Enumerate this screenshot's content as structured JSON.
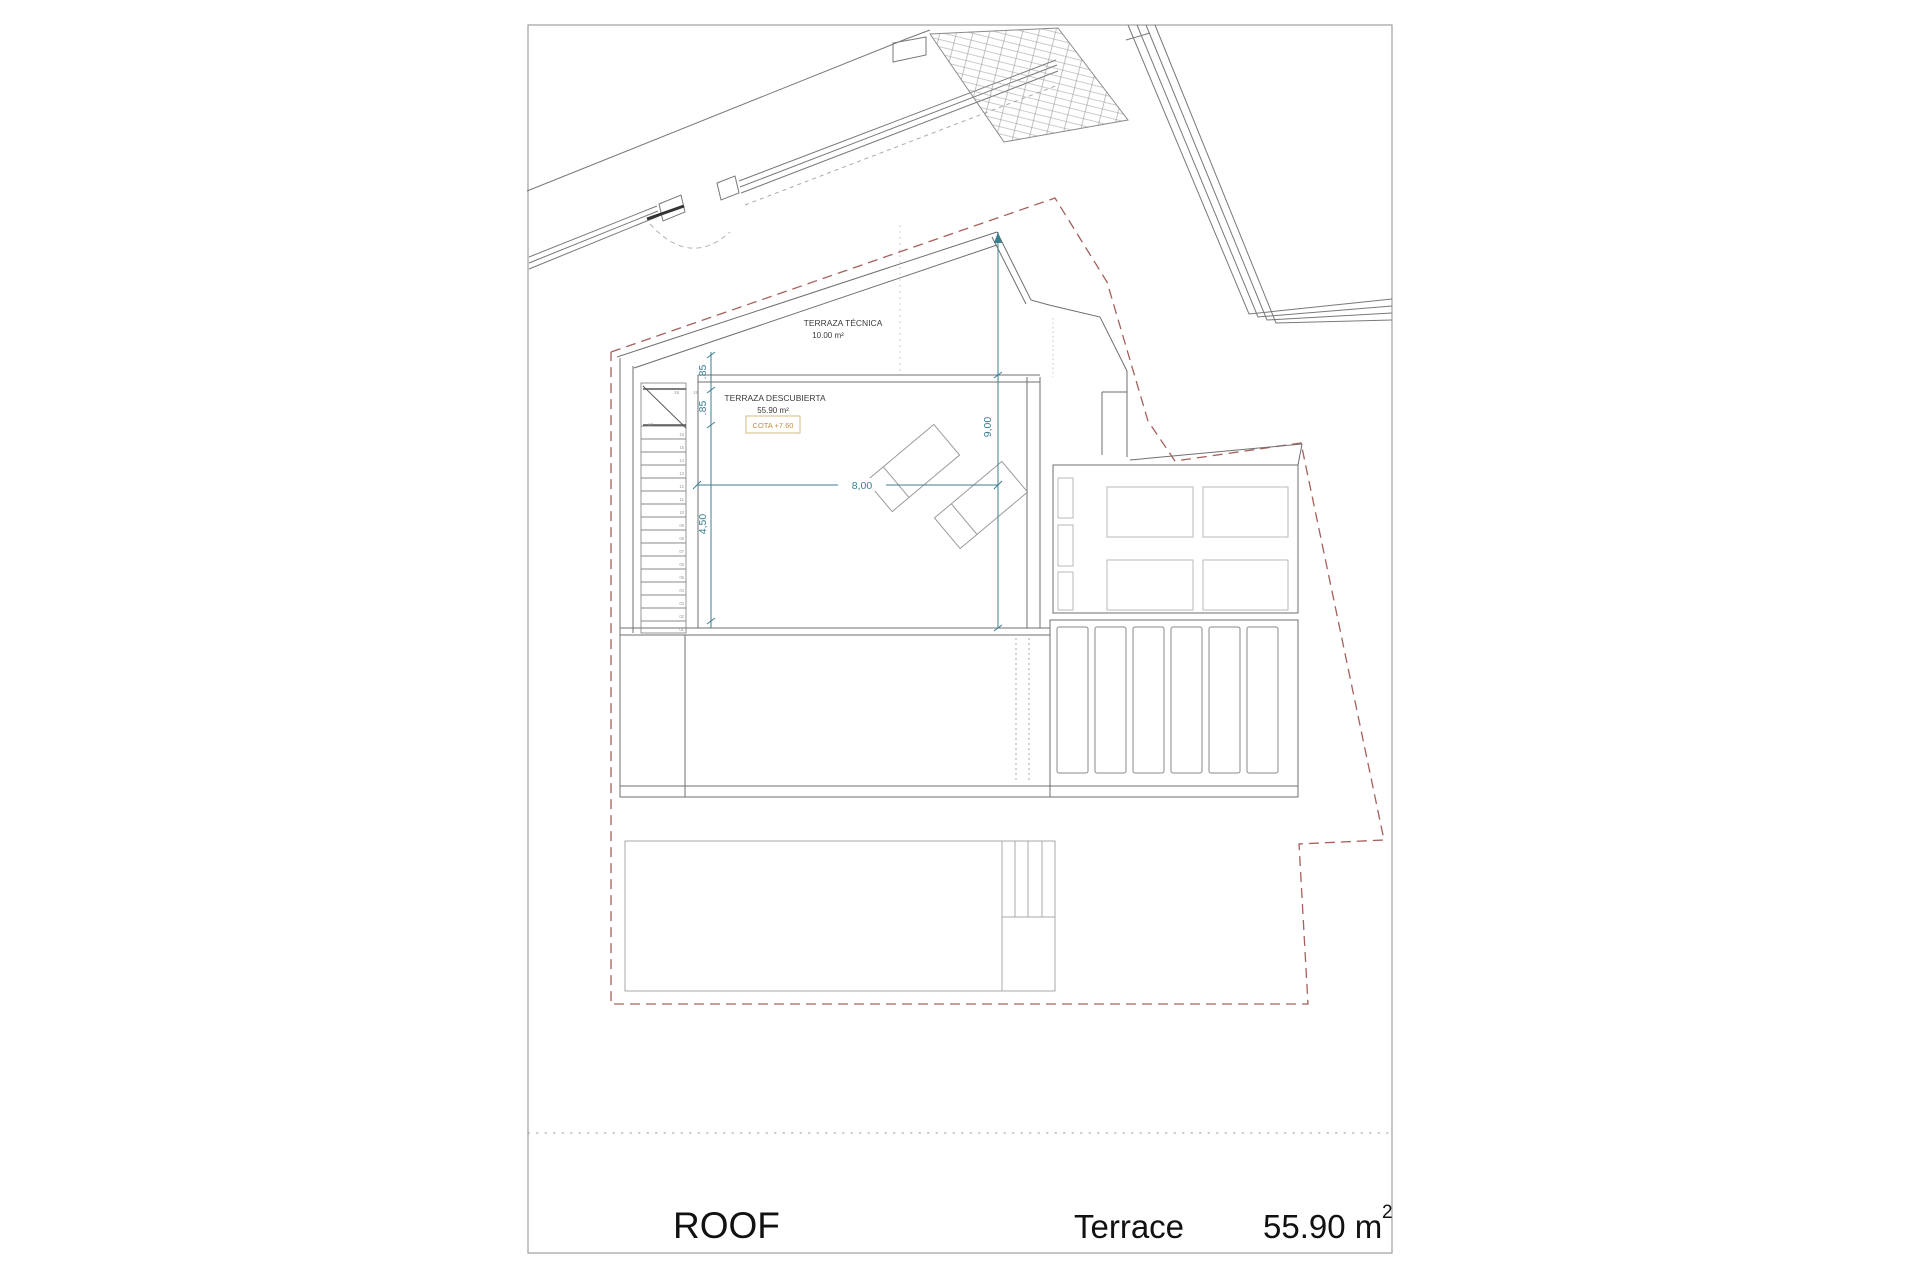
{
  "titleblock": {
    "floor": "ROOF",
    "space": "Terrace",
    "area_value": "55.90 m",
    "area_sup": "2"
  },
  "labels": {
    "tecnica_name": "TERRAZA TÉCNICA",
    "tecnica_area": "10.00 m²",
    "descubierta_name": "TERRAZA DESCUBIERTA",
    "descubierta_area": "55.90 m²",
    "cota": "COTA +7.60"
  },
  "dims": {
    "offset_top": ".85",
    "offset_mid": ".85",
    "depth": "4,50",
    "width": "8,00",
    "height": "9,00"
  },
  "stairs": {
    "numbers": [
      "01",
      "02",
      "03",
      "04",
      "05",
      "06",
      "07",
      "08",
      "09",
      "10",
      "11",
      "12",
      "13",
      "14",
      "15",
      "16",
      "17",
      "18",
      "19"
    ]
  },
  "colors": {
    "line_gray": "#6f6f6f",
    "light_gray": "#b9b9b9",
    "dimension_teal": "#3c7f91",
    "boundary_red": "#a5605c",
    "cota_text": "#c09040",
    "cota_border": "#d4b982"
  }
}
